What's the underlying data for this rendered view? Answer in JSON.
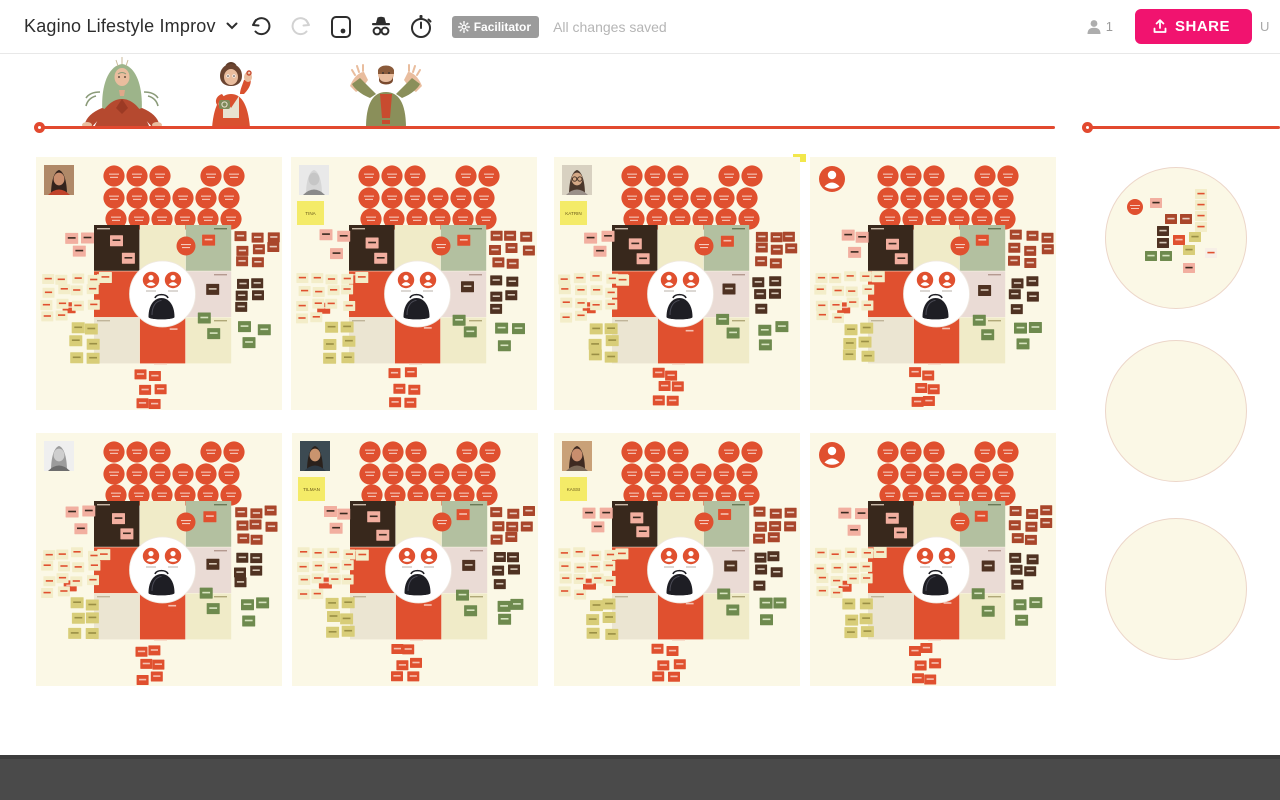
{
  "topbar": {
    "title": "Kagino Lifestyle Improv",
    "facilitator_label": "Facilitator",
    "status_text": "All changes saved",
    "participants_count": "1",
    "share_label": "SHARE",
    "edge_letter": "U"
  },
  "boards": [
    {
      "avatar_kind": "photo",
      "name_sticky": "",
      "avatar_palette": {
        "bg": "#b08968",
        "hair": "#33231d",
        "skin": "#c98e6e",
        "shirt": "#c0432b",
        "glasses": false
      }
    },
    {
      "avatar_kind": "photo",
      "name_sticky": "TINA",
      "avatar_palette": {
        "bg": "#e9e9e9",
        "hair": "#d6d6d6",
        "skin": "#c6c6c6",
        "shirt": "#8a8a8a",
        "glasses": false
      }
    },
    {
      "avatar_kind": "photo",
      "name_sticky": "KATRIN",
      "avatar_palette": {
        "bg": "#d8d1c1",
        "hair": "#4a372c",
        "skin": "#d4a886",
        "shirt": "#9a9089",
        "glasses": true
      }
    },
    {
      "avatar_kind": "placeholder",
      "name_sticky": "",
      "avatar_palette": null
    },
    {
      "avatar_kind": "photo",
      "name_sticky": "",
      "avatar_palette": {
        "bg": "#efefef",
        "hair": "#9c9c9c",
        "skin": "#cecece",
        "shirt": "#6d6d6d",
        "glasses": false
      }
    },
    {
      "avatar_kind": "photo",
      "name_sticky": "TILMAN",
      "avatar_palette": {
        "bg": "#3c4a52",
        "hair": "#2a211c",
        "skin": "#c9946e",
        "shirt": "#2d3a45",
        "glasses": false
      }
    },
    {
      "avatar_kind": "photo",
      "name_sticky": "KASSI",
      "avatar_palette": {
        "bg": "#c9a178",
        "hair": "#3e2a21",
        "skin": "#c98e6e",
        "shirt": "#7c6a59",
        "glasses": false
      }
    },
    {
      "avatar_kind": "placeholder",
      "name_sticky": "",
      "avatar_palette": null
    }
  ],
  "right_panel": {
    "circle_count": 3,
    "first_circle_note_colors": [
      "circle",
      "pink",
      "cream",
      "cream",
      "cream",
      "cream",
      "rust",
      "rust",
      "brown",
      "brown",
      "red",
      "olive",
      "olive",
      "green",
      "green",
      "white",
      "pink"
    ]
  },
  "colors": {
    "board_bg": "#FBF8E6",
    "red": "#E0502F",
    "pink": "#F2AFA0",
    "cream_note": "#F3EDC9",
    "olive": "#D8CD78",
    "green": "#6E8A4E",
    "brown": "#4F3222",
    "rust": "#A9462B",
    "dark_cell": "#38281C",
    "cream_cell": "#F0EBC8",
    "center_cell": "#F4EFD9",
    "sage_cell": "#B3C0A0",
    "rose_cell": "#EADBD5",
    "beige_cell": "#EBE5D2",
    "yellow_note": "#F4EB68",
    "share_pink": "#F1136F",
    "line_red": "#E2492F",
    "white_note": "#F7EFE6"
  }
}
